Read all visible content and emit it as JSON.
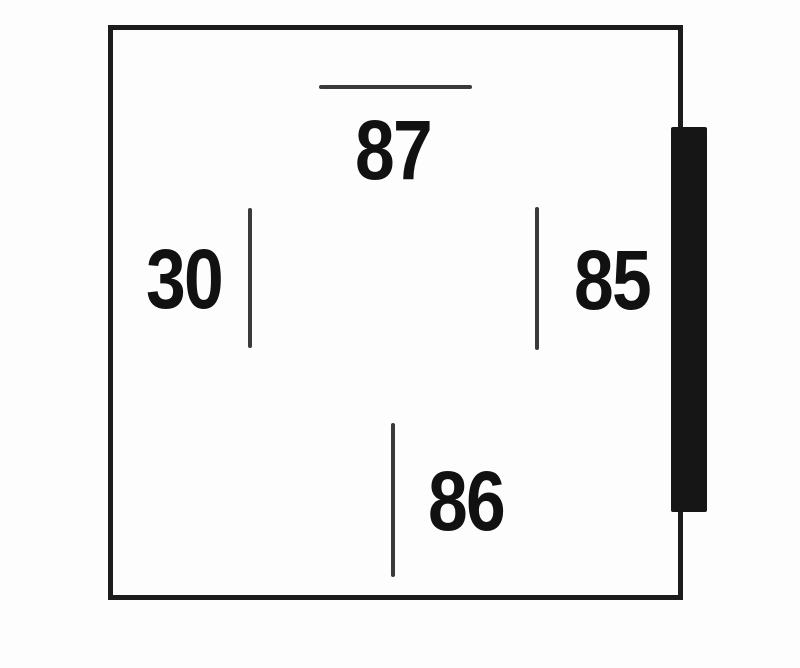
{
  "diagram": {
    "type": "relay-pin-diagram",
    "pins": [
      {
        "id": "87",
        "label": "87",
        "position": "top"
      },
      {
        "id": "30",
        "label": "30",
        "position": "left"
      },
      {
        "id": "85",
        "label": "85",
        "position": "right"
      },
      {
        "id": "86",
        "label": "86",
        "position": "bottom"
      }
    ],
    "colors": {
      "outline": "#1c1c1c",
      "pin_line": "#3a3a3a",
      "label": "#111111",
      "tab": "#161616",
      "background": "#fdfdfd"
    }
  }
}
